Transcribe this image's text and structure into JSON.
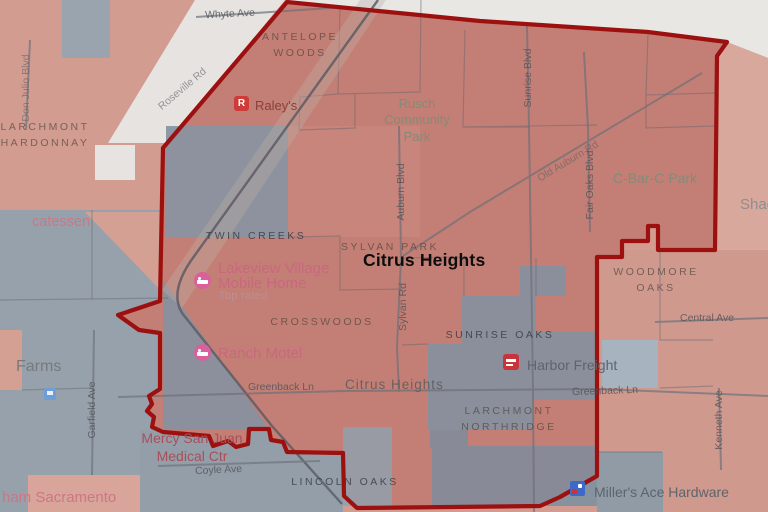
{
  "city": {
    "title": "Citrus Heights"
  },
  "colors": {
    "boundary_red": "#9c1010",
    "tract_red": "#c6857b",
    "tract_gray": "#8d99a6",
    "outside_red": "#d4a094",
    "outside_gray": "#97a1ab"
  },
  "neighborhoods": {
    "antelope_woods": "ANTELOPE WOODS",
    "larchmont_hardonnay": "LARCHMONT HARDONNAY",
    "twin_creeks": "TWIN CREEKS",
    "sylvan_park": "SYLVAN PARK",
    "crosswoods": "CROSSWOODS",
    "sunrise_oaks": "SUNRISE OAKS",
    "woodmore_oaks": "WOODMORE OAKS",
    "larchmont_northridge": "LARCHMONT NORTHRIDGE",
    "lincoln_oaks": "LINCOLN OAKS",
    "farms": "Farms",
    "citrus_heights_small": "Citrus Heights",
    "shadow_partial": "Shad",
    "catessen_partial": "catessen",
    "ham_sacramento_partial": "ham Sacramento"
  },
  "parks": {
    "rusch": "Rusch Community Park",
    "cbarc": "C-Bar-C Park"
  },
  "streets": {
    "whyte": "Whyte Ave",
    "roseville": "Roseville Rd",
    "sunrise": "Sunrise Blvd",
    "old_auburn": "Old Auburn Rd",
    "fair_oaks": "Fair Oaks Blvd",
    "auburn": "Auburn Blvd",
    "sylvan": "Sylvan Rd",
    "greenback_w": "Greenback Ln",
    "greenback_e": "Greenback Ln",
    "central": "Central Ave",
    "kenneth": "Kenneth Ave",
    "garfield": "Garfield Ave",
    "coyle": "Coyle Ave",
    "don_julio": "Don Julio Blvd"
  },
  "pois": {
    "raleys": {
      "name": "Raley's",
      "icon_letter": "R"
    },
    "lakeview": {
      "name": "Lakeview Village Mobile Home",
      "badge": "Top rated"
    },
    "ranch_motel": {
      "name": "Ranch Motel"
    },
    "harbor_freight": {
      "name": "Harbor Freight"
    },
    "millers_ace": {
      "name": "Miller's Ace Hardware"
    },
    "mercy": {
      "name": "Mercy San Juan Medical Ctr"
    }
  }
}
